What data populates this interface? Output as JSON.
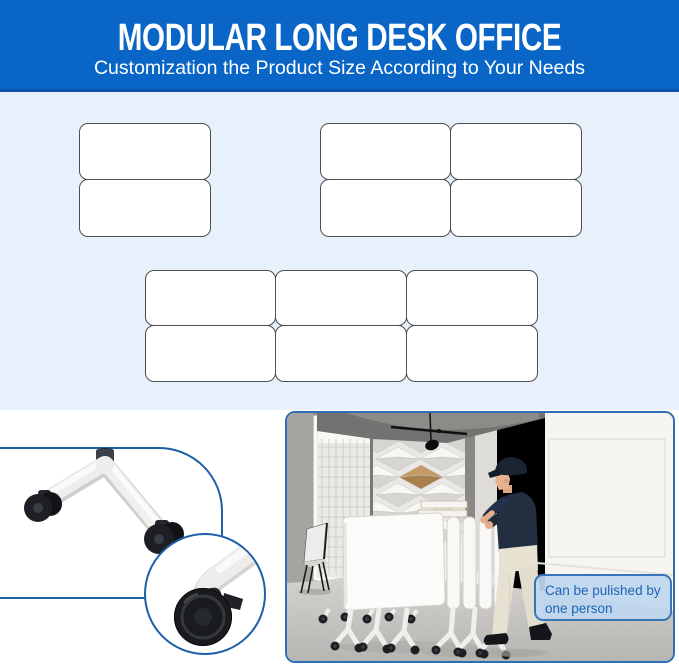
{
  "banner": {
    "title": "MODULAR LONG DESK OFFICE",
    "subtitle": "Customization the Product Size According to Your Needs"
  },
  "layout_diagrams": {
    "groups": [
      {
        "id": "layout-1x2",
        "columns": 1,
        "rows": 2,
        "desk_count": 2
      },
      {
        "id": "layout-2x2",
        "columns": 2,
        "rows": 2,
        "desk_count": 4
      },
      {
        "id": "layout-3x2",
        "columns": 3,
        "rows": 2,
        "desk_count": 6
      }
    ]
  },
  "detail_view": {
    "icons": [
      "desk-leg-icon",
      "caster-wheel-icon",
      "caster-brake-detail-icon"
    ]
  },
  "photo": {
    "callout_text": "Can be pulished by one person",
    "scene_icons": [
      "worker-pushing-desks-icon",
      "stacked-folding-desks-icon",
      "office-chair-icon",
      "window-icon",
      "diamond-wall-panel-icon",
      "track-light-icon"
    ]
  },
  "colors": {
    "banner_bg": "#0a66c6",
    "banner_border": "#0a53a6",
    "banner_text": "#ffffff",
    "section_bg": "#e8f1fb",
    "desk_fill": "#ffffff",
    "desk_border": "#4e4e4e",
    "accent_blue": "#1d5fa8",
    "photo_border": "#2d6fb7",
    "callout_bg": "#bdd6ef",
    "callout_border": "#3874b8",
    "callout_text": "#1f64b4"
  }
}
